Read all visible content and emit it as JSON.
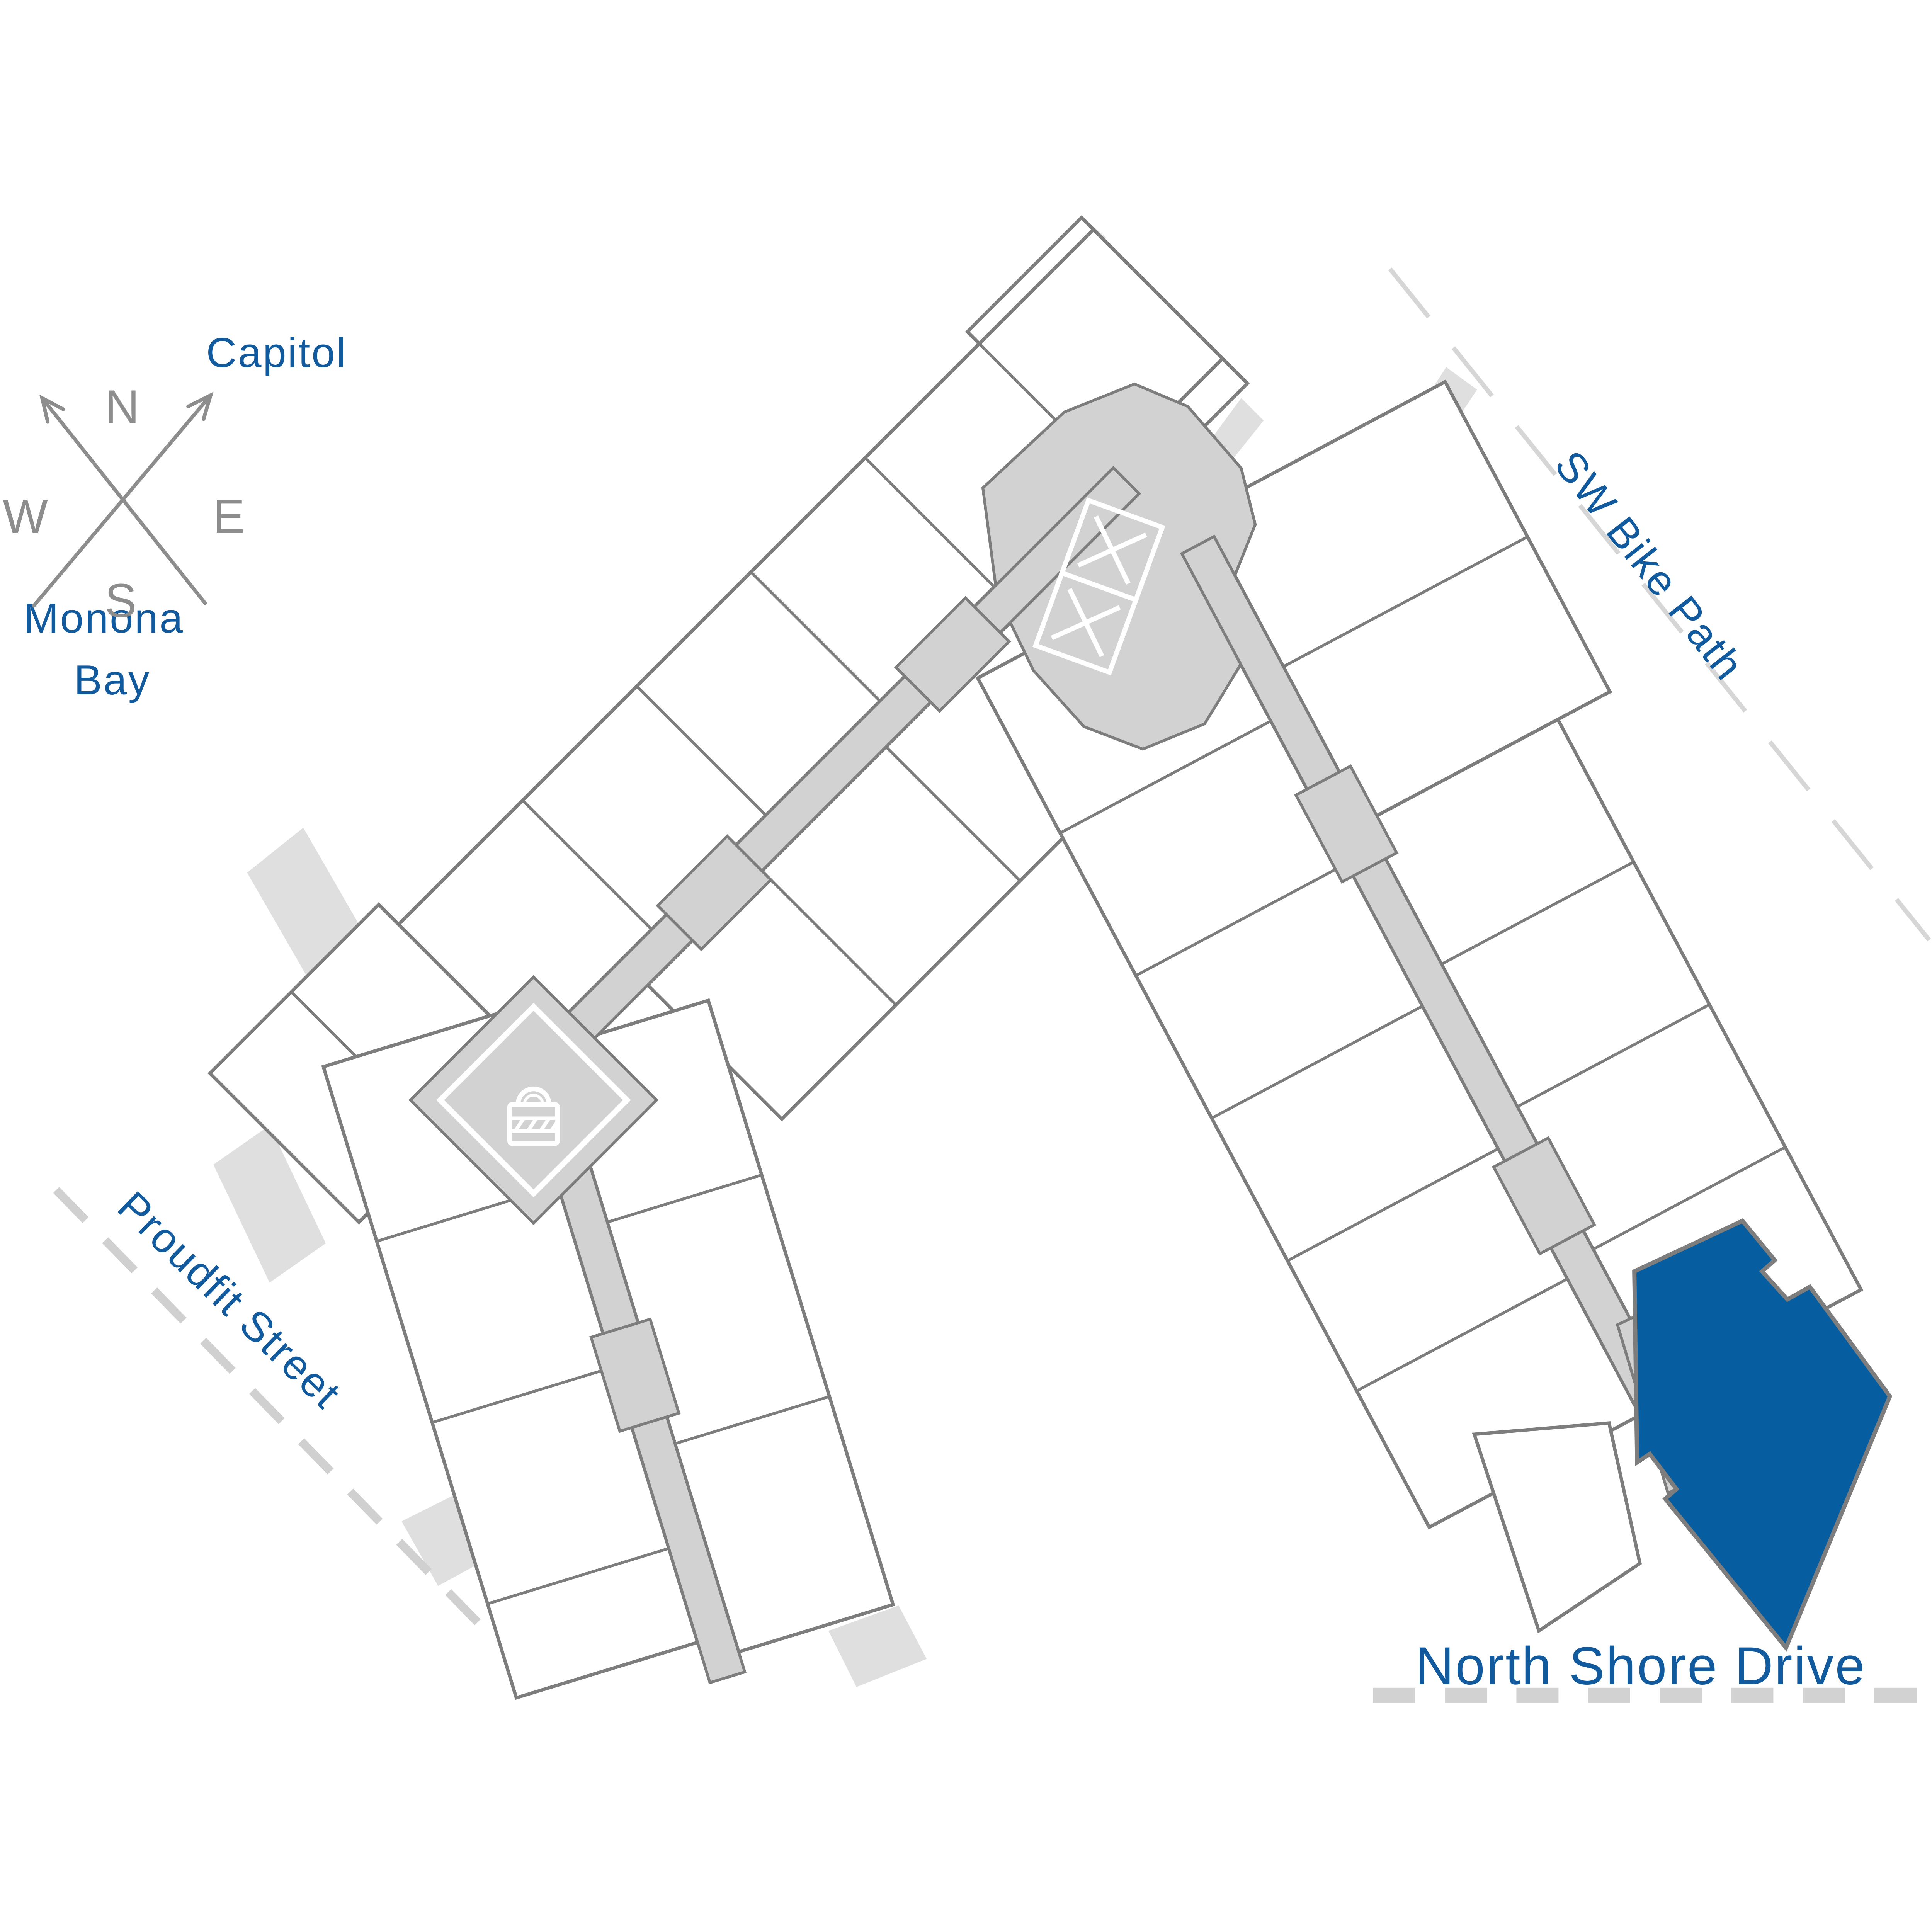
{
  "compass": {
    "north": "N",
    "east": "E",
    "south": "S",
    "west": "W"
  },
  "landmarks": {
    "capitol": "Capitol",
    "monona_bay_line1": "Monona",
    "monona_bay_line2": "Bay"
  },
  "streets": {
    "sw_bike_path": "SW Bike Path",
    "proudfit_street": "Proudfit Street",
    "north_shore_drive": "North Shore Drive"
  },
  "icons": {
    "elevators": "elevator-x-icon",
    "secure_entry": "padlock-icon",
    "compass": "compass-rose-icon"
  },
  "colors": {
    "accent_blue": "#115a9e",
    "selected_unit_fill": "#065d9f",
    "unit_outline": "#7d7d7d",
    "corridor_fill": "#d2d2d2",
    "shadow_fill": "#dfdfdf",
    "dashed_road_gray": "#d2d2d2",
    "compass_gray": "#8d8d8d"
  },
  "selected_unit": {
    "state": "highlighted"
  }
}
